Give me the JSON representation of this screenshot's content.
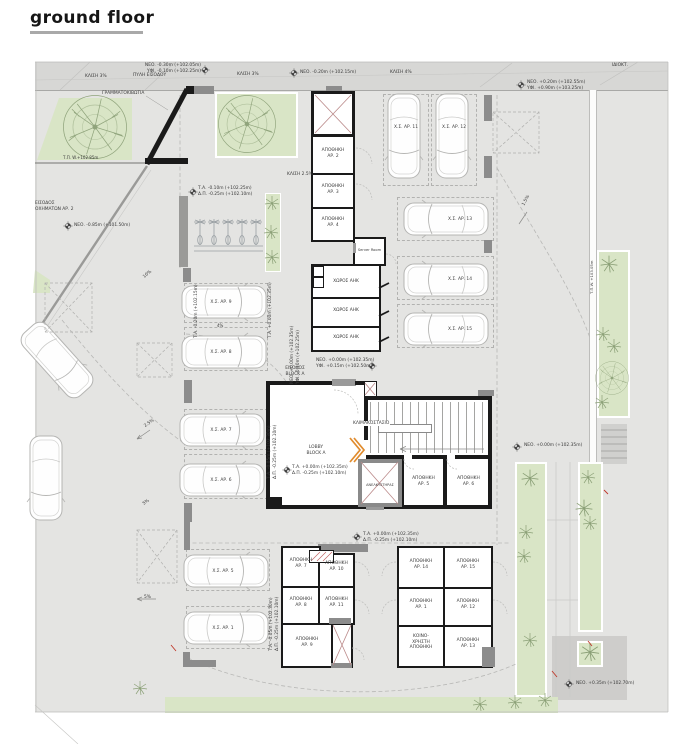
{
  "title": "ground floor",
  "colors": {
    "site": "#e4e4e2",
    "sidewalk": "#d7d7d5",
    "green": "#d9e5c6",
    "wall": "#1a1a1a",
    "gray_wall": "#8c8c8c",
    "door_accent": "#e08b2d",
    "mark_red": "#c0392b"
  },
  "site": {
    "slope3_left": "ΚΛΙΣΗ 3%",
    "slope3_right": "ΚΛΙΣΗ 3%",
    "slope4": "ΚΛΙΣΗ 4%",
    "slope25": "ΚΛΙΣΗ 2.5%",
    "pct10": "10%",
    "pct25": "2.5%",
    "pct4": "4%",
    "pct5a": "5%",
    "pct5b": "5%",
    "pct15": "1.5%",
    "gate": "ΠΥΛΗ ΕΙΣΟΔΟΥ",
    "mailboxes": "ΓΡΑΜΜΑΤΟΚΙΒΩΤΙΑ",
    "property": "ΙΔΙΟΚΤ.",
    "vehicle_entrance_l1": "ΕΙΣΟΔΟΣ",
    "vehicle_entrance_l2": "ΟΧΗΜΑΤΩΝ ΑΡ. 2",
    "block_entrance_l1": "ΕΙΣΟΔΟΣ",
    "block_entrance_l2": "BLOCK A"
  },
  "levels": {
    "top_neo": "ΝΕΟ. -0.30m (+102.05m)",
    "top_yfi": "ΥΦΙ. -0.10m (+102.25m)",
    "mid_neo": "ΝΕΟ. -0.20m (+102.15m)",
    "ne_neo": "ΝΕΟ. +0.20m (+102.55m)",
    "ne_yfi": "ΥΦΙ. +0.90m (+103.25m)",
    "tpw_left": "Τ.Π. W.+102.85m",
    "road_neo": "ΝΕΟ. -0.85m (+101.50m)",
    "bike_ta": "Τ.Α. -0.10m (+102.25m)",
    "bike_dp": "Δ.Π. -0.25m (+102.10m)",
    "p9_ta": "Τ.Α. -0.20m (+102.15m)",
    "p8_ta": "Τ.Α. +0.00m (+102.35m)",
    "entry_neo": "ΝΕΟ. +0.00m (+102.35m)",
    "entry_yfi": "ΥΦΙ. -0.10m (+102.25m)",
    "ahk_neo": "ΝΕΟ. +0.00m (+102.35m)",
    "ahk_yfi": "ΥΦΙ. +0.15m (+102.50m)",
    "lobby_ta": "Τ.Α. +0.00m (+102.35m)",
    "lobby_dp": "Δ.Π. -0.25m (+102.10m)",
    "p67_ta": "Τ.Α. -0.05m (+102.30m)",
    "p67_dp": "Δ.Π. -0.25m (+102.10m)",
    "court_neo": "ΝΕΟ. +0.00m (+102.35m)",
    "south_ta": "Τ.Α. +0.00m (+102.35m)",
    "south_dp": "Δ.Π. -0.25m (+102.10m)",
    "p51_ta": "Τ.Α. -0.05m (+102.30m)",
    "p51_dp": "Δ.Π. -0.25m (+102.10m)",
    "tpw_right": "Τ.Π.W. +103.05m",
    "se_neo": "ΝΕΟ. +0.35m (+102.70m)"
  },
  "rooms": {
    "label": "ΑΠΟΘΗΚΗ",
    "ap1": "ΑΡ. 1",
    "ap2": "ΑΡ. 2",
    "ap3": "ΑΡ. 3",
    "ap4": "ΑΡ. 4",
    "ap5": "ΑΡ. 5",
    "ap6": "ΑΡ. 6",
    "ap7": "ΑΡ. 7",
    "ap8": "ΑΡ. 8",
    "ap9": "ΑΡ. 9",
    "ap10": "ΑΡ. 10",
    "ap11": "ΑΡ. 11",
    "ap12": "ΑΡ. 12",
    "ap13": "ΑΡ. 13",
    "ap14": "ΑΡ. 14",
    "ap15": "ΑΡ. 15",
    "server": "Server Room",
    "ahk": "ΧΩΡΟΣ ΑΗΚ",
    "stairs": "ΚΛΙΜΑΚΟΣΤΑΣΙΟ",
    "lobby_l1": "LOBBY",
    "lobby_l2": "BLOCK A",
    "lift": "ΑΝΕΛΚΥΣΤΗΡΑΣ",
    "common_l1": "ΚΟΙΝΟ-",
    "common_l2": "ΧΡΗΣΤΗ",
    "common_l3": "ΑΠΟΘΗΚΗ"
  },
  "parking": {
    "p1": "Χ.Σ. ΑΡ. 1",
    "p5": "Χ.Σ. ΑΡ. 5",
    "p6": "Χ.Σ. ΑΡ. 6",
    "p7": "Χ.Σ. ΑΡ. 7",
    "p8": "Χ.Σ. ΑΡ. 8",
    "p9": "Χ.Σ. ΑΡ. 9",
    "p11": "Χ.Σ. ΑΡ. 11",
    "p12": "Χ.Σ. ΑΡ. 12",
    "p13": "Χ.Σ. ΑΡ. 13",
    "p14": "Χ.Σ. ΑΡ. 14",
    "p15": "Χ.Σ. ΑΡ. 15"
  }
}
